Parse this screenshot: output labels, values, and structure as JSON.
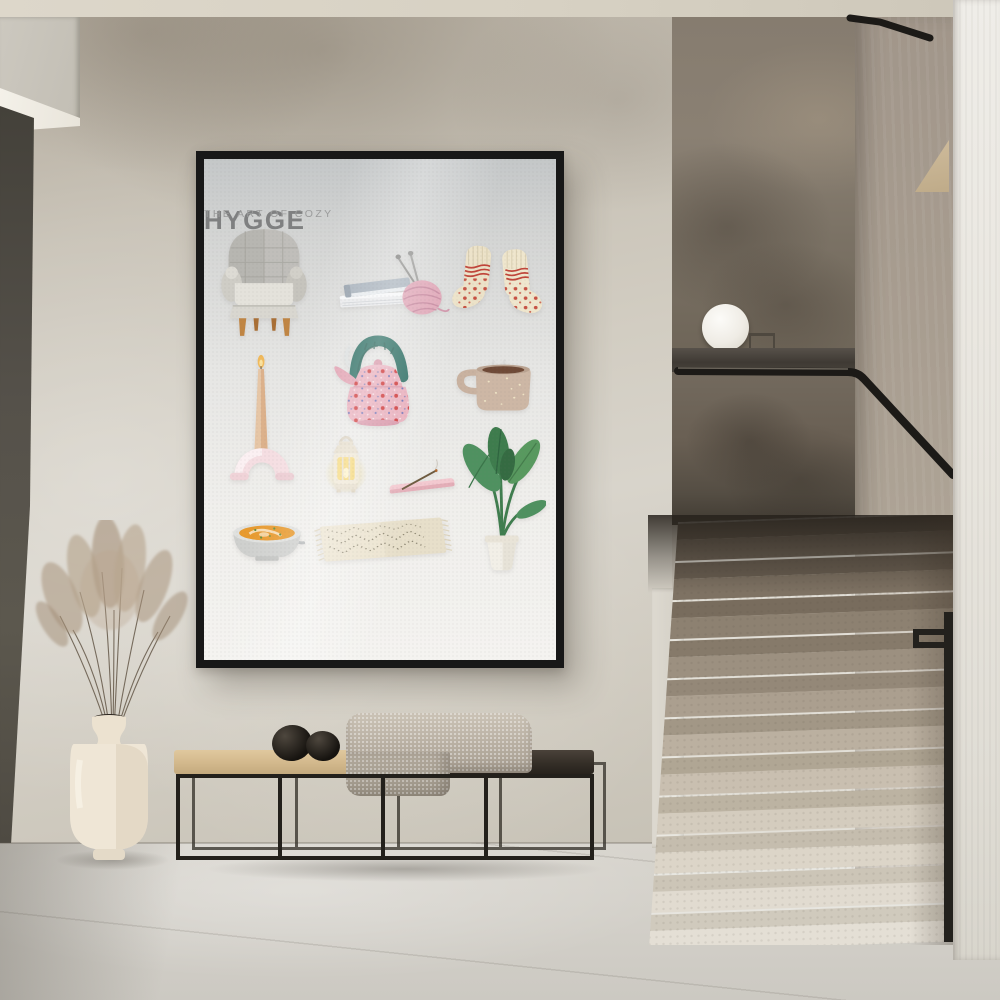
{
  "poster": {
    "title": "HYGGE",
    "subtitle": "THE ART OF COZY",
    "items": [
      "armchair",
      "books-and-yarn",
      "wool-socks",
      "taper-candle-in-arch-holder",
      "polka-dot-tea-kettle",
      "speckled-mug",
      "glowing-lantern",
      "incense-stick-on-tray",
      "potted-plant",
      "bowl-of-soup",
      "patterned-rug"
    ]
  },
  "colors": {
    "wall": "#cbc5ba",
    "ceiling": "#d9d3c6",
    "poster_frame": "#181818",
    "poster_background": "#eeeeec",
    "poster_title_text": "#7f8081",
    "kettle_pink": "#e9aebc",
    "kettle_handle_teal": "#2c6e63",
    "plant_green": "#4f9160",
    "soup_orange": "#e89a2e",
    "bench_wood": "#d5bc92",
    "bench_frame": "#23201b",
    "blanket": "#b7aea1",
    "vase": "#ece3d2",
    "stair_stone_light": "#ded9cf",
    "stair_stone_dark": "#7c7164",
    "railing_black": "#1c1a17",
    "floor": "#d5d2cb"
  }
}
